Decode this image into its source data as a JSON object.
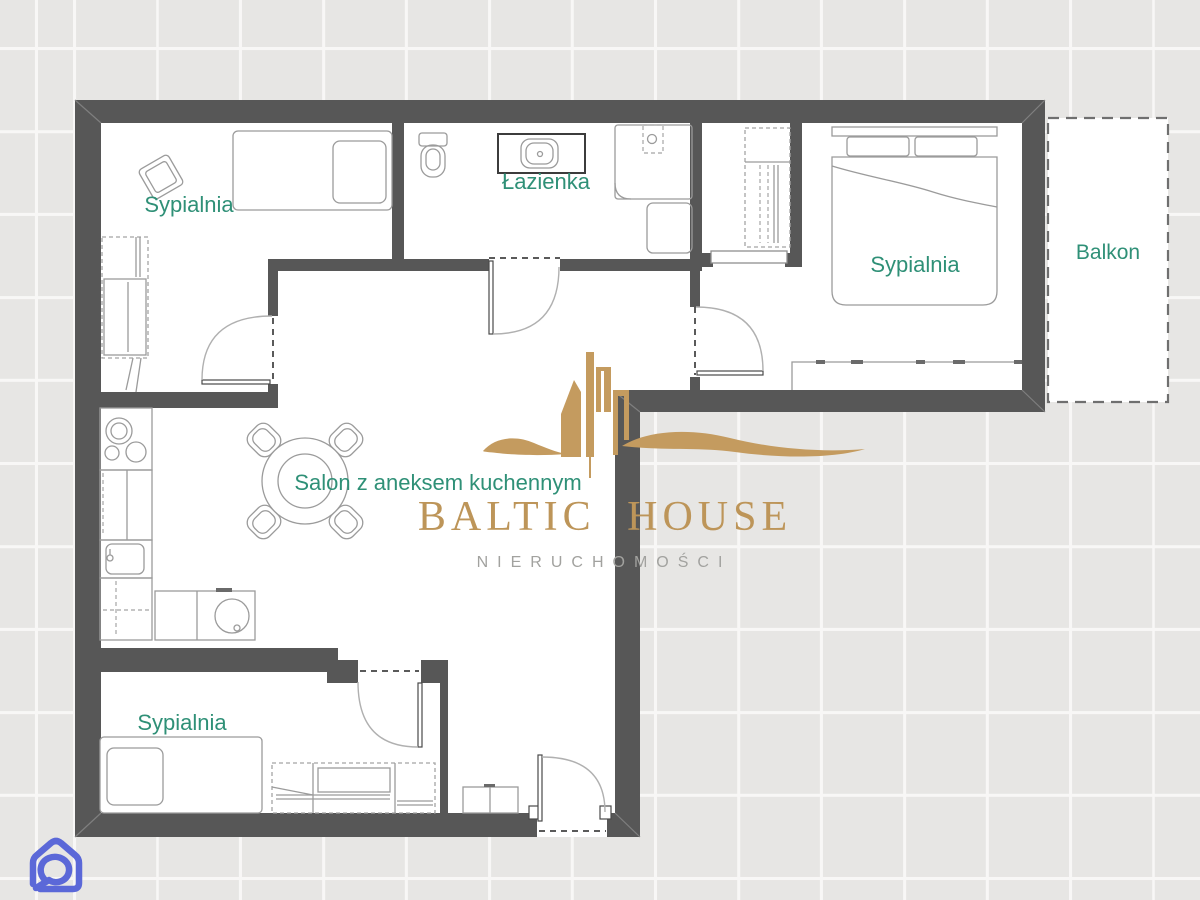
{
  "floorplan": {
    "rooms": [
      {
        "id": "bedroom-top-left",
        "label": "Sypialnia"
      },
      {
        "id": "bathroom",
        "label": "Łazienka"
      },
      {
        "id": "bedroom-right",
        "label": "Sypialnia"
      },
      {
        "id": "living-room",
        "label": "Salon z aneksem kuchennym"
      },
      {
        "id": "bedroom-bottom-left",
        "label": "Sypialnia"
      },
      {
        "id": "balcony",
        "label": "Balkon"
      }
    ],
    "colors": {
      "wall": "#575757",
      "room_floor": "#ffffff",
      "room_label": "#2f9077",
      "furniture_line": "#9b9b9b",
      "tile_background": "#e7e6e4",
      "tile_grout": "#f8f7f6"
    }
  },
  "watermark": {
    "brand": "BALTIC HOUSE",
    "tagline": "NIERUCHOMOŚCI",
    "brand_color": "#bd9559",
    "graphic_color": "#c49b5f",
    "tagline_color": "#a2a29f"
  },
  "corner_logo": {
    "icon": "house-spiral-icon",
    "color": "#5b68d8"
  }
}
